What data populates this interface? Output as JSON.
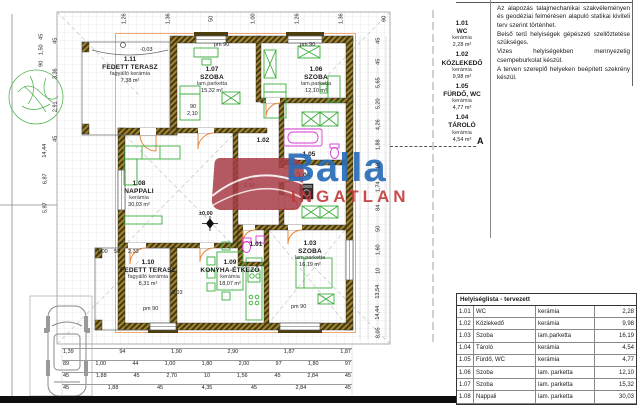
{
  "watermark": {
    "brand": "Balla",
    "brand_sub": "INGATLAN"
  },
  "colors": {
    "brand_blue": "#2a6db8",
    "brand_red": "#c03535",
    "wall_hatch": "#8a7430",
    "furniture_green": "#3aae3a",
    "fixture_magenta": "#d43ad4",
    "door_orange": "#e8853a"
  },
  "rooms": [
    {
      "id": "1.11",
      "name": "FEDETT TERASZ",
      "material": "fagyálló kerámia",
      "area": "7,38 m²"
    },
    {
      "id": "1.07",
      "name": "SZOBA",
      "material": "lam.parketta",
      "area": "15,32 m²"
    },
    {
      "id": "1.06",
      "name": "SZOBA",
      "material": "lam.parketta",
      "area": "12,10 m²"
    },
    {
      "id": "1.02"
    },
    {
      "id": "1.05"
    },
    {
      "id": "1.04"
    },
    {
      "id": "1.08",
      "name": "NAPPALI",
      "material": "kerámia",
      "area": "30,03 m²"
    },
    {
      "id": "1.01"
    },
    {
      "id": "1.03",
      "name": "SZOBA",
      "material": "lam.parketta",
      "area": "16,19 m²"
    },
    {
      "id": "1.09",
      "name": "KONYHA-ÉTKEZŐ",
      "material": "kerámia",
      "area": "18,07 m²"
    },
    {
      "id": "1.10",
      "name": "FEDETT TERASZ",
      "material": "fagyálló kerámia",
      "area": "8,31 m²"
    }
  ],
  "legend": [
    {
      "id": "1.01",
      "name": "WC",
      "material": "kerámia",
      "area": "2,28 m²"
    },
    {
      "id": "1.02",
      "name": "KÖZLEKEDŐ",
      "material": "kerámia",
      "area": "9,98 m²"
    },
    {
      "id": "1.05",
      "name": "FÜRDŐ, WC",
      "material": "kerámia",
      "area": "4,77 m²"
    },
    {
      "id": "1.04",
      "name": "TÁROLÓ",
      "material": "kerámia",
      "area": "4,54 m²"
    }
  ],
  "section_marker": "A",
  "notes": {
    "p1": "Az alapozás talajmechanikai szakvéleményen és geodéziai felmérésen alapuló statikai kiviteli terv szerint történhet.",
    "p2": "Belső terű helyiségek gépészeti szellőztetése szükséges.",
    "p3": "Vizes helyiségekben mennyezetig csempeburkolat készül.",
    "p4": "A terven szereplő helyeken beépített szekrény készül."
  },
  "table": {
    "title": "Helyiséglista - tervezett",
    "rows": [
      {
        "num": "1.01",
        "name": "WC",
        "material": "kerámia",
        "area": "2,28"
      },
      {
        "num": "1.02",
        "name": "Közlekedő",
        "material": "kerámia",
        "area": "9,98"
      },
      {
        "num": "1.03",
        "name": "Szoba",
        "material": "lam.parketta",
        "area": "16,19"
      },
      {
        "num": "1.04",
        "name": "Tároló",
        "material": "kerámia",
        "area": "4,54"
      },
      {
        "num": "1.05",
        "name": "Fürdő, WC",
        "material": "kerámia",
        "area": "4,77"
      },
      {
        "num": "1.06",
        "name": "Szoba",
        "material": "lam. parketta",
        "area": "12,10"
      },
      {
        "num": "1.07",
        "name": "Szoba",
        "material": "lam. parketta",
        "area": "15,32"
      },
      {
        "num": "1.08",
        "name": "Nappali",
        "material": "lam. parketta",
        "area": "30,03"
      }
    ]
  },
  "dims": {
    "b1": [
      "1,39",
      "94",
      "1,90",
      "2,90",
      "1,87",
      "1,87"
    ],
    "b2": [
      "89",
      "1,00",
      "44",
      "1,00",
      "1,80",
      "2,00",
      "97",
      "1,80",
      "97"
    ],
    "b3": [
      "45",
      "1,88",
      "45",
      "2,70",
      "10",
      "1,56",
      "45",
      "2,84",
      "45"
    ],
    "b4": [
      "45",
      "1,88",
      "45",
      "4,35",
      "45",
      "2,84",
      "45"
    ],
    "top": [
      "1,26",
      "1,36",
      "50",
      "1,00",
      "1,26",
      "1,36",
      "60"
    ],
    "top_left": [
      "45",
      "1,50",
      "90"
    ],
    "left_upper": [
      "45",
      "3,36",
      "2,91",
      "45"
    ],
    "left_lower": [
      "14,44",
      "6,87",
      "5,97"
    ],
    "right_col": [
      "45",
      "45",
      "5,65",
      "5,20",
      "4,26",
      "1,88",
      "10",
      "1,74",
      "84",
      "50",
      "1,60",
      "10",
      "13,54",
      "14,44",
      "8,05"
    ],
    "marks": [
      "±0,00",
      "-0,03",
      "-0,03",
      "pm 90",
      "pm 90",
      "pm 90",
      "pm 90",
      "90",
      "2,10",
      "90",
      "2,10",
      "1,00",
      "50",
      "2,33"
    ]
  }
}
